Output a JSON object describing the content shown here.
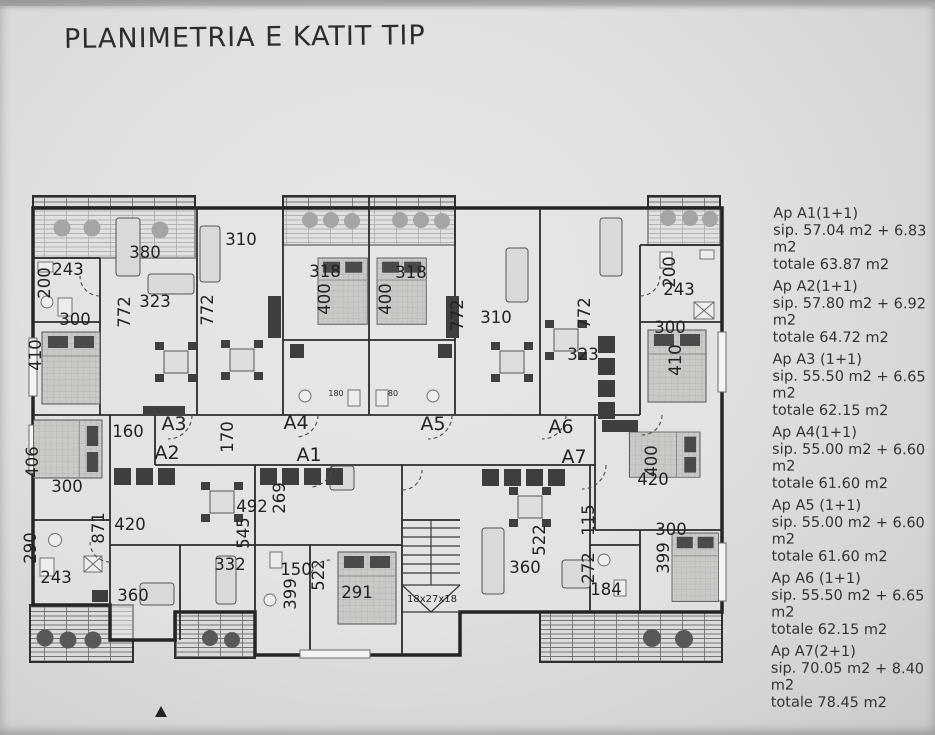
{
  "photo": {
    "title": "PLANIMETRIA E KATIT TIP"
  },
  "legend": {
    "items": [
      {
        "name": "Ap A1(1+1)",
        "sip": "sip. 57.04 m2 + 6.83",
        "sip2": "m2",
        "totale": "totale 63.87 m2"
      },
      {
        "name": "Ap A2(1+1)",
        "sip": "sip. 57.80 m2 + 6.92",
        "sip2": "m2",
        "totale": "totale 64.72 m2"
      },
      {
        "name": "Ap A3 (1+1)",
        "sip": "sip. 55.50 m2 + 6.65",
        "sip2": "m2",
        "totale": "totale 62.15 m2"
      },
      {
        "name": "Ap A4(1+1)",
        "sip": "sip. 55.00 m2 + 6.60",
        "sip2": "m2",
        "totale": "totale 61.60 m2"
      },
      {
        "name": "Ap A5 (1+1)",
        "sip": "sip. 55.00 m2 + 6.60",
        "sip2": "m2",
        "totale": "totale 61.60 m2"
      },
      {
        "name": "Ap A6 (1+1)",
        "sip": "sip. 55.50 m2 + 6.65",
        "sip2": "m2",
        "totale": "totale 62.15 m2"
      },
      {
        "name": "Ap A7(2+1)",
        "sip": "sip. 70.05 m2 + 8.40",
        "sip2": "m2",
        "totale": "totale 78.45 m2"
      }
    ]
  },
  "plan": {
    "apartment_labels": [
      {
        "t": "A3",
        "x": 174,
        "y": 430
      },
      {
        "t": "A2",
        "x": 167,
        "y": 459
      },
      {
        "t": "A4",
        "x": 296,
        "y": 429
      },
      {
        "t": "A1",
        "x": 309,
        "y": 461
      },
      {
        "t": "A5",
        "x": 433,
        "y": 430
      },
      {
        "t": "A6",
        "x": 561,
        "y": 433
      },
      {
        "t": "A7",
        "x": 574,
        "y": 463
      }
    ],
    "dim_labels": [
      {
        "t": "380",
        "x": 145,
        "y": 258
      },
      {
        "t": "243",
        "x": 68,
        "y": 275
      },
      {
        "t": "200",
        "x": 50,
        "y": 283,
        "r": -90
      },
      {
        "t": "323",
        "x": 155,
        "y": 307
      },
      {
        "t": "772",
        "x": 130,
        "y": 312,
        "r": -90
      },
      {
        "t": "300",
        "x": 75,
        "y": 325
      },
      {
        "t": "410",
        "x": 41,
        "y": 355,
        "r": -90
      },
      {
        "t": "310",
        "x": 241,
        "y": 245
      },
      {
        "t": "772",
        "x": 213,
        "y": 310,
        "r": -90
      },
      {
        "t": "318",
        "x": 325,
        "y": 277
      },
      {
        "t": "400",
        "x": 330,
        "y": 299,
        "r": -90
      },
      {
        "t": "318",
        "x": 411,
        "y": 278
      },
      {
        "t": "400",
        "x": 391,
        "y": 299,
        "r": -90
      },
      {
        "t": "772",
        "x": 463,
        "y": 315,
        "r": -90
      },
      {
        "t": "310",
        "x": 496,
        "y": 323
      },
      {
        "t": "772",
        "x": 590,
        "y": 313,
        "r": -90
      },
      {
        "t": "323",
        "x": 583,
        "y": 360
      },
      {
        "t": "200",
        "x": 675,
        "y": 272,
        "r": -90
      },
      {
        "t": "243",
        "x": 679,
        "y": 295
      },
      {
        "t": "300",
        "x": 670,
        "y": 333
      },
      {
        "t": "410",
        "x": 681,
        "y": 360,
        "r": -90
      },
      {
        "t": "160",
        "x": 128,
        "y": 437
      },
      {
        "t": "170",
        "x": 233,
        "y": 437,
        "r": -90
      },
      {
        "t": "406",
        "x": 38,
        "y": 462,
        "r": -90
      },
      {
        "t": "300",
        "x": 67,
        "y": 492
      },
      {
        "t": "492",
        "x": 252,
        "y": 512
      },
      {
        "t": "269",
        "x": 285,
        "y": 498,
        "r": -90
      },
      {
        "t": "871",
        "x": 104,
        "y": 528,
        "r": -90
      },
      {
        "t": "420",
        "x": 130,
        "y": 530
      },
      {
        "t": "290",
        "x": 36,
        "y": 548,
        "r": -90
      },
      {
        "t": "243",
        "x": 56,
        "y": 583
      },
      {
        "t": "545",
        "x": 249,
        "y": 533,
        "r": -90
      },
      {
        "t": "332",
        "x": 230,
        "y": 570
      },
      {
        "t": "360",
        "x": 133,
        "y": 601
      },
      {
        "t": "150",
        "x": 296,
        "y": 575
      },
      {
        "t": "399",
        "x": 296,
        "y": 594,
        "r": -90
      },
      {
        "t": "522",
        "x": 324,
        "y": 575,
        "r": -90
      },
      {
        "t": "291",
        "x": 357,
        "y": 598
      },
      {
        "t": "400",
        "x": 657,
        "y": 461,
        "r": -90
      },
      {
        "t": "420",
        "x": 653,
        "y": 485
      },
      {
        "t": "522",
        "x": 545,
        "y": 540,
        "r": -90
      },
      {
        "t": "115",
        "x": 594,
        "y": 520,
        "r": -90
      },
      {
        "t": "360",
        "x": 525,
        "y": 573
      },
      {
        "t": "272",
        "x": 594,
        "y": 568,
        "r": -90
      },
      {
        "t": "184",
        "x": 606,
        "y": 595
      },
      {
        "t": "300",
        "x": 671,
        "y": 535
      },
      {
        "t": "399",
        "x": 669,
        "y": 558,
        "r": -90
      },
      {
        "t": "18x27x18",
        "x": 432,
        "y": 602,
        "s": 10
      },
      {
        "t": "180",
        "x": 336,
        "y": 396,
        "s": 8
      },
      {
        "t": "80",
        "x": 393,
        "y": 396,
        "s": 8
      }
    ]
  }
}
